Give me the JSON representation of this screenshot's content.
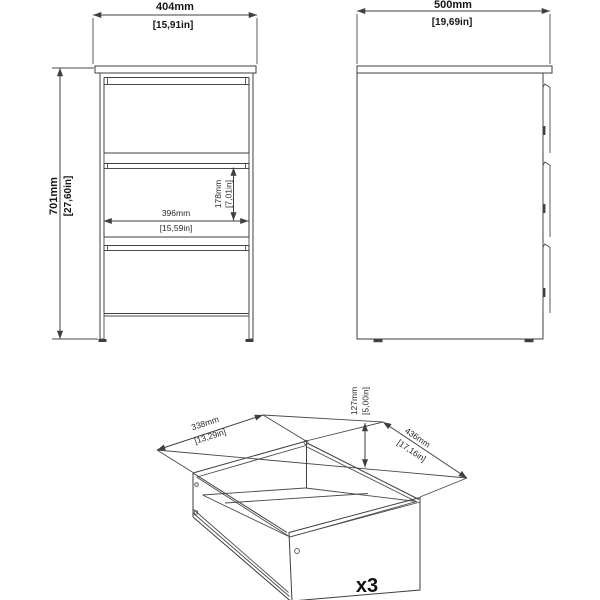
{
  "drawing": {
    "front_view": {
      "width": {
        "mm": "404mm",
        "inch": "[15,91in]"
      },
      "height": {
        "mm": "701mm",
        "inch": "[27,60in]"
      },
      "drawer_inner_width": {
        "mm": "396mm",
        "inch": "[15,59in]"
      },
      "drawer_inner_height": {
        "mm": "178mm",
        "inch": "[7,01in]"
      }
    },
    "side_view": {
      "depth": {
        "mm": "500mm",
        "inch": "[19,69in]"
      }
    },
    "drawer_view": {
      "width": {
        "mm": "338mm",
        "inch": "[13,29in]"
      },
      "height": {
        "mm": "127mm",
        "inch": "[5,00in]"
      },
      "depth": {
        "mm": "436mm",
        "inch": "[17,16in]"
      },
      "quantity": "x3"
    }
  },
  "colors": {
    "line": "#3f3f3f",
    "text": "#161616",
    "background": "#ffffff"
  }
}
